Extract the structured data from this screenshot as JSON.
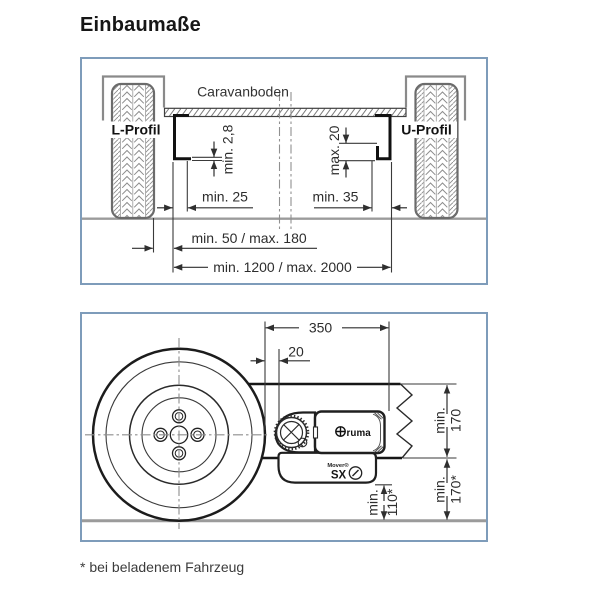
{
  "page": {
    "title": "Einbaumaße",
    "footnote": "* bei beladenem Fahrzeug"
  },
  "colors": {
    "frame": "#7e9cba",
    "line_dark": "#1f1f1f",
    "line_gray": "#8c8c8c",
    "ground": "#9b9b9b"
  },
  "top_diagram": {
    "floor_label": "Caravanboden",
    "left_rail_label": "L-Profil",
    "right_rail_label": "U-Profil",
    "dim_lip_thickness": "min. 2,8",
    "dim_lip_height": "max. 20",
    "dim_left_flat": "min. 25",
    "dim_right_flat": "min. 35",
    "dim_tyre_to_rail": "min. 50 / max. 180",
    "dim_rail_span": "min. 1200 / max. 2000"
  },
  "bottom_diagram": {
    "dim_depth": "350",
    "dim_roller_gap": "20",
    "dim_rail_clearance": {
      "line1": "min.",
      "line2": "170"
    },
    "dim_rail_to_ground": {
      "line1": "min.",
      "line2": "170*"
    },
    "dim_mover_to_ground": {
      "line1": "min.",
      "line2": "110*"
    },
    "brand": "truma",
    "brand_rest": "ruma",
    "model_label": "Mover®",
    "model": "SX"
  }
}
